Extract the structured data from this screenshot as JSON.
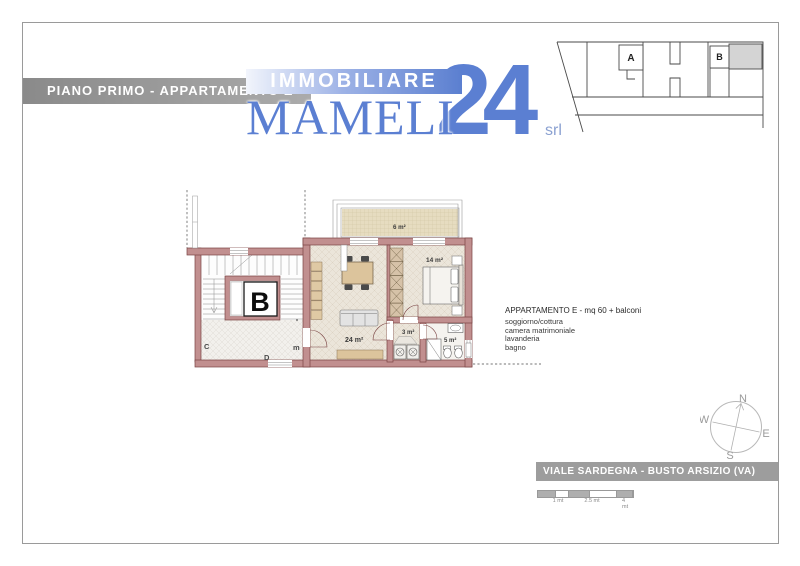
{
  "banners": {
    "title": "PIANO PRIMO - APPARTAMENTO E",
    "address": "VIALE SARDEGNA - BUSTO ARSIZIO (VA)"
  },
  "logo": {
    "top": "IMMOBILIARE",
    "name": "MAMELI",
    "number": "24",
    "suffix": "srl",
    "blue": "#5b7fd2"
  },
  "site_plan": {
    "unit_a": "A",
    "unit_b": "B"
  },
  "floor_plan": {
    "elevator": "B",
    "letters": {
      "c": "C",
      "d": "D",
      "m": "m"
    },
    "areas": {
      "balcony": "6 m²",
      "living": "24 m²",
      "bedroom": "14 m²",
      "laundry": "3 m²",
      "bathroom": "5 m²"
    }
  },
  "description": {
    "title": "APPARTAMENTO E - mq 60 + balconi",
    "lines": [
      "soggiorno/cottura",
      "camera matrimoniale",
      "lavanderia",
      "bagno"
    ]
  },
  "compass": {
    "n": "N",
    "e": "E",
    "s": "S",
    "w": "W"
  },
  "scale": {
    "labels": [
      "1 mt",
      "2.5 mt",
      "4 mt"
    ]
  },
  "colors": {
    "banner_gray": "#9d9d9d",
    "wall_fill": "#c18f8f",
    "wall_stroke": "#7a4343",
    "site_gray": "#d4d4d4"
  }
}
